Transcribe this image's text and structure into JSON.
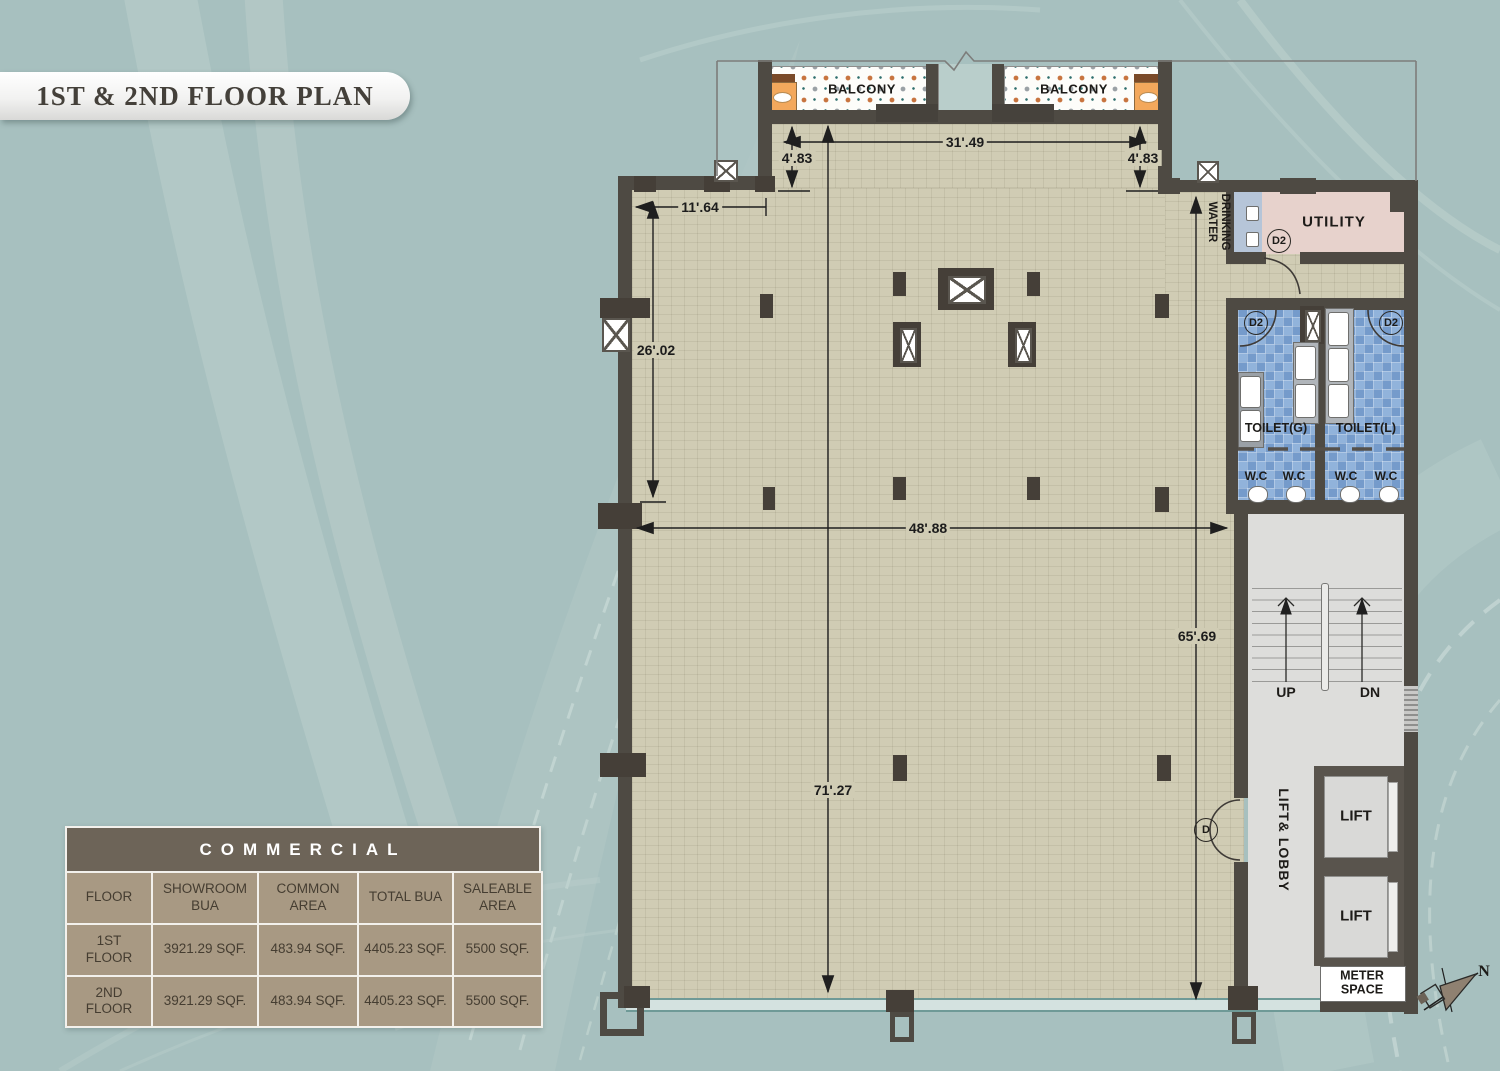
{
  "title": "1ST & 2ND FLOOR PLAN",
  "commercial": {
    "title": "COMMERCIAL",
    "headers": [
      "FLOOR",
      "SHOWROOM BUA",
      "COMMON AREA",
      "TOTAL BUA",
      "SALEABLE AREA"
    ],
    "rows": [
      {
        "floor": "1ST FLOOR",
        "showroom_bua": "3921.29 SQF.",
        "common_area": "483.94 SQF.",
        "total_bua": "4405.23 SQF.",
        "saleable_area": "5500 SQF."
      },
      {
        "floor": "2ND FLOOR",
        "showroom_bua": "3921.29 SQF.",
        "common_area": "483.94 SQF.",
        "total_bua": "4405.23 SQF.",
        "saleable_area": "5500 SQF."
      }
    ]
  },
  "plan": {
    "rooms": {
      "balcony": "BALCONY",
      "drinking_water": "DRINKING\nWATER",
      "utility": "UTILITY",
      "toilet_g": "TOILET(G)",
      "toilet_l": "TOILET(L)",
      "wc": "W.C",
      "lift_lobby": "LIFT& LOBBY",
      "lift": "LIFT",
      "meter_space": "METER\nSPACE"
    },
    "stairs": {
      "up": "UP",
      "dn": "DN"
    },
    "doors": {
      "d2": "D2",
      "d": "D"
    },
    "compass_north": "N",
    "dimensions": {
      "top_width": "31'.49",
      "recess_left": "4'.83",
      "recess_right": "4'.83",
      "top_left_width": "11'.64",
      "left_height": "26'.02",
      "mid_width": "48'.88",
      "right_height": "65'.69",
      "full_height": "71'.27"
    }
  },
  "colors": {
    "background": "#a7c0bf",
    "wall": "#4e4a43",
    "floor": "#d0ccb4",
    "toilet_tile": "#7fa6d5",
    "utility": "#e7d2cc",
    "drinking_water": "#b6c5d8",
    "lobby": "#dddddb",
    "balcony_planter": "#f3a85c",
    "table_header": "#6d6458",
    "table_cell": "#a89983"
  }
}
